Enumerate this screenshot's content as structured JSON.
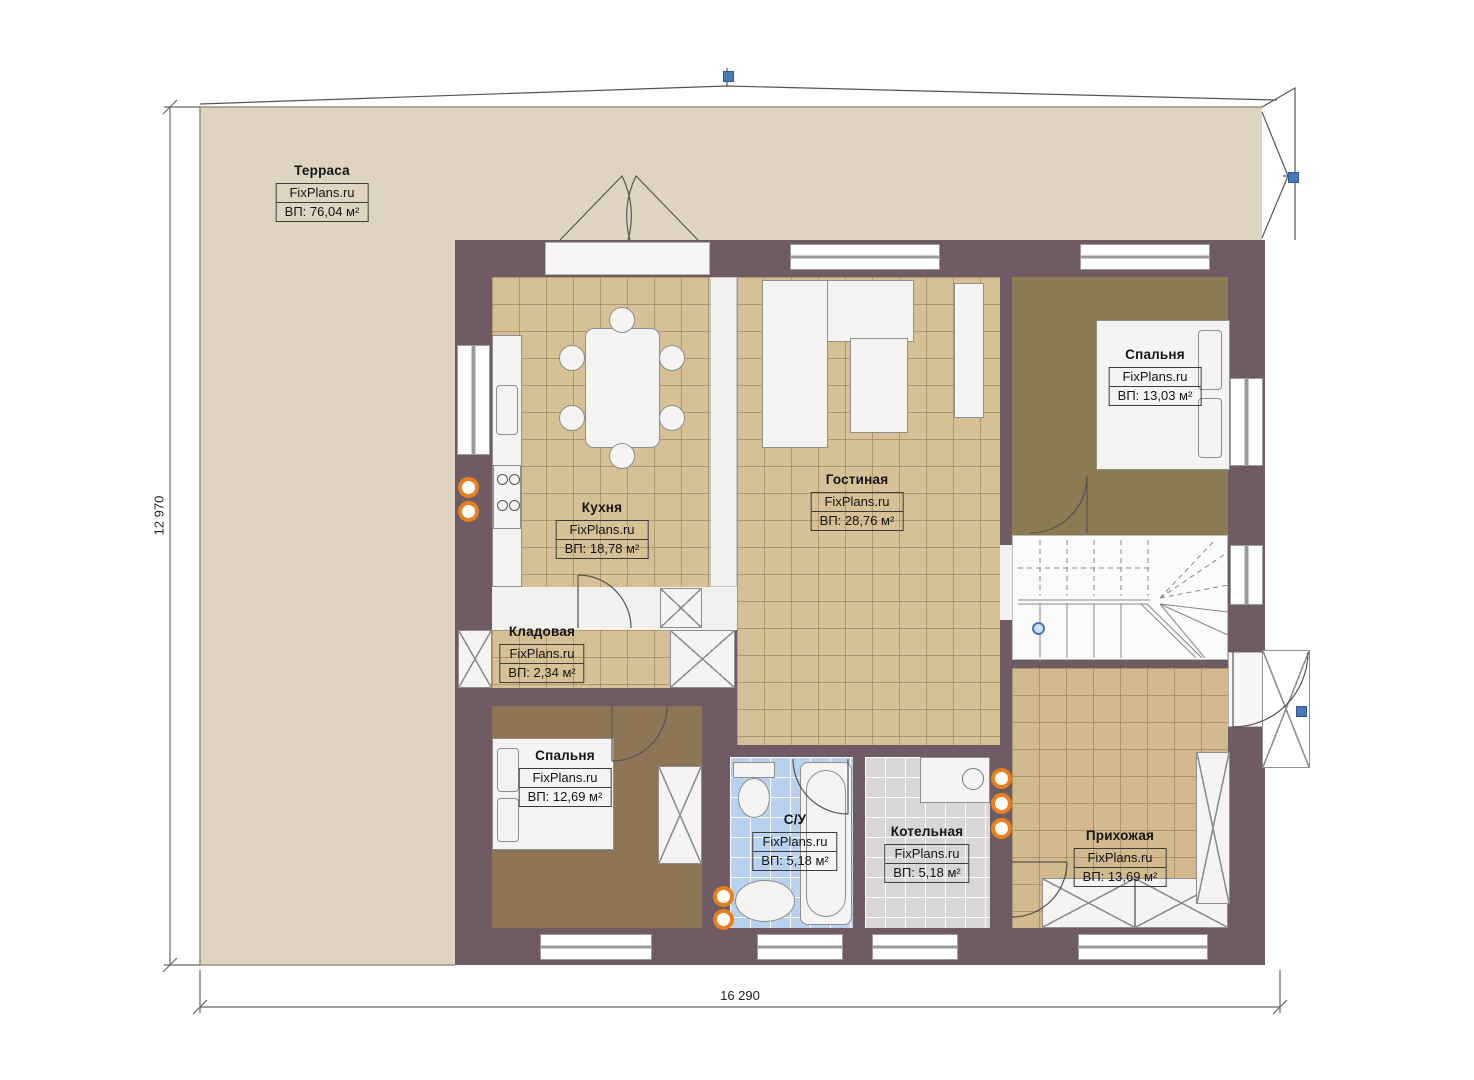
{
  "brand": "FixPlans.ru",
  "rooms": [
    {
      "id": "terrace",
      "name": "Терраса",
      "area": "ВП: 76,04 м²"
    },
    {
      "id": "kitchen",
      "name": "Кухня",
      "area": "ВП: 18,78 м²"
    },
    {
      "id": "living-room",
      "name": "Гостиная",
      "area": "ВП: 28,76 м²"
    },
    {
      "id": "bedroom-top-right",
      "name": "Спальня",
      "area": "ВП: 13,03 м²"
    },
    {
      "id": "storage",
      "name": "Кладовая",
      "area": "ВП: 2,34 м²"
    },
    {
      "id": "bedroom-bottom-left",
      "name": "Спальня",
      "area": "ВП: 12,69 м²"
    },
    {
      "id": "bathroom",
      "name": "С/У",
      "area": "ВП: 5,18 м²"
    },
    {
      "id": "boiler-room",
      "name": "Котельная",
      "area": "ВП: 5,18 м²"
    },
    {
      "id": "hallway",
      "name": "Прихожая",
      "area": "ВП: 13,69 м²"
    }
  ],
  "dimensions": {
    "width_mm": "16 290",
    "height_mm": "12 970"
  },
  "colors": {
    "wall": "#6f5b63",
    "terrace": "#ded4c1",
    "tile_tan": "#d6c095",
    "carpet_olive": "#8b7a52",
    "carpet_brown": "#8d7555",
    "tile_blue": "#b7d1ee",
    "tile_gray": "#d8d7d5",
    "handle_blue": "#4a7ab5",
    "socket_orange": "#e8801f"
  }
}
